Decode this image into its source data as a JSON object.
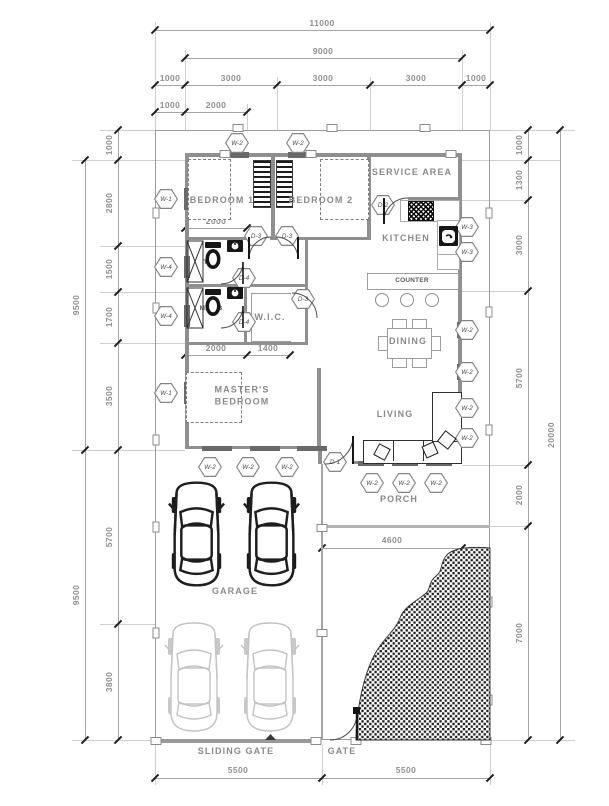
{
  "drawing": {
    "rooms": {
      "bedroom1": "BEDROOM 1",
      "bedroom2": "BEDROOM 2",
      "service_area": "SERVICE AREA",
      "kitchen": "KITCHEN",
      "counter": "COUNTER",
      "dining": "DINING",
      "living": "LIVING",
      "wic": "W.I.C.",
      "master": "MASTER'S\nBEDROOM",
      "tb": "T.&B.",
      "mtb": "M.T.&B",
      "porch": "PORCH",
      "garage": "GARAGE",
      "sliding_gate": "SLIDING GATE",
      "gate": "GATE"
    },
    "markers": {
      "w1": "W-1",
      "w2": "W-2",
      "w3": "W-3",
      "w4": "W-4",
      "d1": "D-1",
      "d2": "D-2",
      "d3": "D-3",
      "d4": "D-4"
    },
    "dims": {
      "top": [
        "11000",
        "9000",
        "1000",
        "3000",
        "3000",
        "3000",
        "1000",
        "1000",
        "2000"
      ],
      "left_inner": [
        "1000",
        "2800",
        "1500",
        "1700",
        "3500",
        "5700",
        "3800"
      ],
      "left_outer": [
        "9500",
        "9500"
      ],
      "right_inner": [
        "1000",
        "1300",
        "3000",
        "5700",
        "2000",
        "7000"
      ],
      "right_outer": [
        "20000"
      ],
      "bottom": [
        "5500",
        "5500"
      ],
      "interior": [
        "2000",
        "2000",
        "1400",
        "4600"
      ]
    },
    "colors": {
      "wall": "#8f8f8f",
      "dim_text": "#8f8f8f",
      "tick": "#1d1d1d",
      "dark": "#1c1c1c"
    }
  }
}
